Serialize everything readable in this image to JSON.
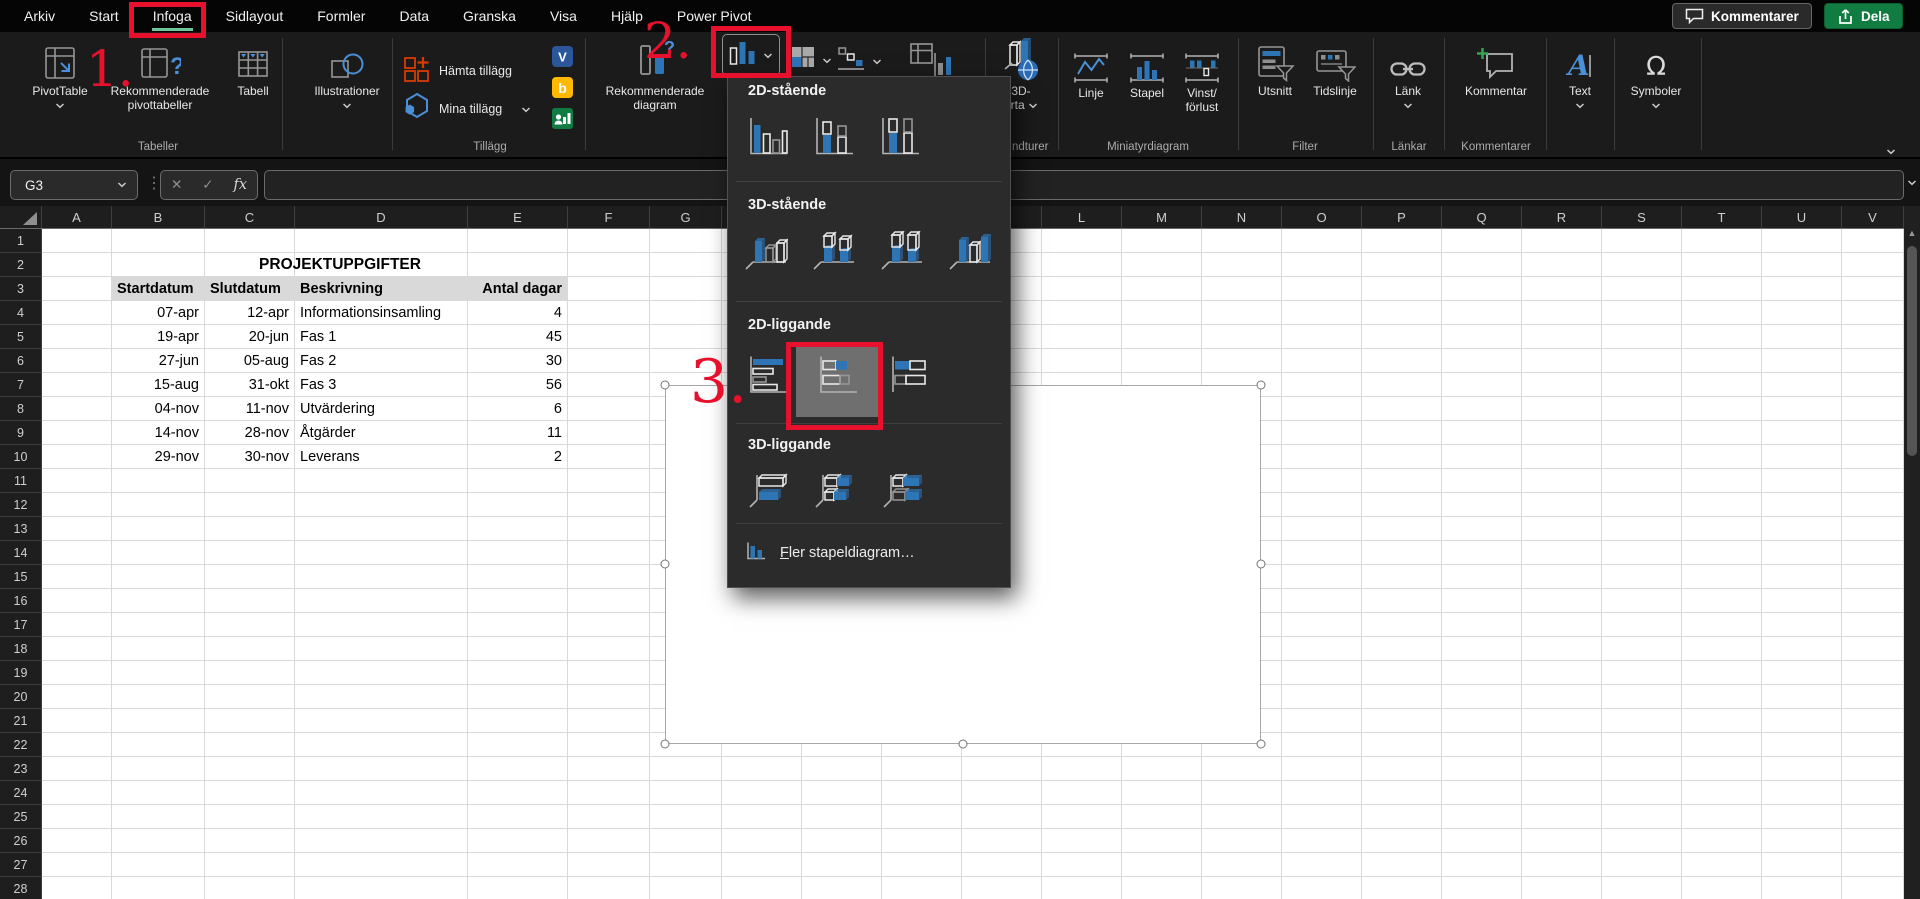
{
  "window": {
    "comments_button": "Kommentarer",
    "share_button": "Dela"
  },
  "menu_tabs": [
    {
      "label": "Arkiv"
    },
    {
      "label": "Start"
    },
    {
      "label": "Infoga",
      "active": true
    },
    {
      "label": "Sidlayout"
    },
    {
      "label": "Formler"
    },
    {
      "label": "Data"
    },
    {
      "label": "Granska"
    },
    {
      "label": "Visa"
    },
    {
      "label": "Hjälp"
    },
    {
      "label": "Power Pivot"
    }
  ],
  "ribbon": {
    "tabeller": {
      "group_label": "Tabeller",
      "pivottable": "PivotTable",
      "rec_pivot_line1": "Rekommenderade",
      "rec_pivot_line2": "pivottabeller",
      "tabell": "Tabell"
    },
    "illustrationer": {
      "label": "Illustrationer"
    },
    "tillagg": {
      "group_label": "Tillägg",
      "get_addins": "Hämta tillägg",
      "my_addins": "Mina tillägg"
    },
    "diagram": {
      "rec_line1": "Rekommenderade",
      "rec_line2": "diagram"
    },
    "rundturer": {
      "group_label_visible": "ndturer",
      "map_line1": "3D-",
      "map_line2": "arta"
    },
    "miniatyrdiagram": {
      "group_label": "Miniatyrdiagram",
      "linje": "Linje",
      "stapel": "Stapel",
      "vinst_line1": "Vinst/",
      "vinst_line2": "förlust"
    },
    "filter": {
      "group_label": "Filter",
      "utsnitt": "Utsnitt",
      "tidslinje": "Tidslinje"
    },
    "lankar": {
      "group_label": "Länkar",
      "lank": "Länk"
    },
    "kommentarer_grp": {
      "group_label": "Kommentarer",
      "kommentar": "Kommentar"
    },
    "textgrp": {
      "text": "Text"
    },
    "symboler_grp": {
      "symboler": "Symboler"
    }
  },
  "formula_bar": {
    "name_box": "G3",
    "fx": "fx",
    "formula_value": ""
  },
  "grid": {
    "columns": [
      "A",
      "B",
      "C",
      "D",
      "E",
      "F",
      "G",
      "H",
      "I",
      "J",
      "K",
      "L",
      "M",
      "N",
      "O",
      "P",
      "Q",
      "R",
      "S",
      "T",
      "U",
      "V"
    ],
    "row_count": 28
  },
  "table": {
    "title": "PROJEKTUPPGIFTER",
    "headers": [
      "Startdatum",
      "Slutdatum",
      "Beskrivning",
      "Antal dagar"
    ],
    "rows": [
      [
        "07-apr",
        "12-apr",
        "Informationsinsamling",
        "4"
      ],
      [
        "19-apr",
        "20-jun",
        "Fas 1",
        "45"
      ],
      [
        "27-jun",
        "05-aug",
        "Fas 2",
        "30"
      ],
      [
        "15-aug",
        "31-okt",
        "Fas 3",
        "56"
      ],
      [
        "04-nov",
        "11-nov",
        "Utvärdering",
        "6"
      ],
      [
        "14-nov",
        "28-nov",
        "Åtgärder",
        "11"
      ],
      [
        "29-nov",
        "30-nov",
        "Leverans",
        "2"
      ]
    ]
  },
  "chart_menu": {
    "sections": [
      {
        "title": "2D-stående",
        "items": [
          "col-clustered",
          "col-stacked",
          "col-100"
        ]
      },
      {
        "title": "3D-stående",
        "items": [
          "col3d-clustered",
          "col3d-stacked",
          "col3d-100",
          "col3d"
        ]
      },
      {
        "title": "2D-liggande",
        "items": [
          "bar-clustered",
          "bar-stacked",
          "bar-100"
        ],
        "selected_index": 1
      },
      {
        "title": "3D-liggande",
        "items": [
          "bar3d-clustered",
          "bar3d-stacked",
          "bar3d-100"
        ]
      }
    ],
    "footer": "Fler stapeldiagram…"
  },
  "annotations": [
    {
      "text": "1."
    },
    {
      "text": "2."
    },
    {
      "text": "3."
    }
  ],
  "colors": {
    "share_green": "#107C41",
    "tab_underline": "#6ec79a",
    "annotation_red": "#e8112d",
    "chart_blue": "#2e75b6",
    "table_header_bg": "#d9d9d9"
  }
}
